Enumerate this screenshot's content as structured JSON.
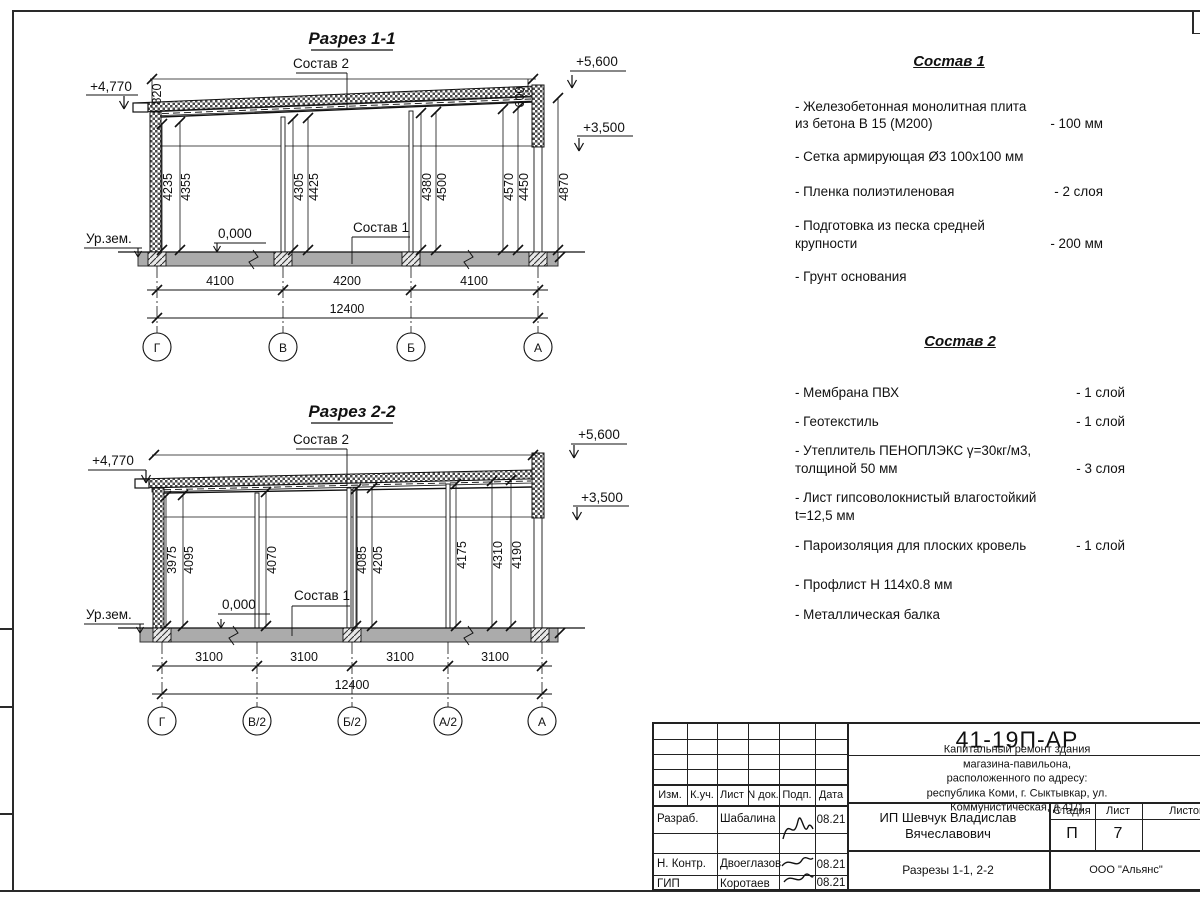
{
  "s1": {
    "title": "Разрез 1-1",
    "sostav2_label": "Состав 2",
    "sostav1_label": "Состав 1",
    "elev_eave": "+4,770",
    "elev_parapet": "+5,600",
    "elev_mid": "+3,500",
    "dim_820": "820",
    "dim_600": "600",
    "dim_4870": "4870",
    "zero": "0,000",
    "ground": "Ур.зем.",
    "heights": [
      "4235",
      "4355",
      "4305",
      "4425",
      "4380",
      "4500",
      "4570",
      "4450"
    ],
    "spans": [
      "4100",
      "4200",
      "4100"
    ],
    "total": "12400",
    "axes": [
      "Г",
      "В",
      "Б",
      "А"
    ]
  },
  "s2": {
    "title": "Разрез 2-2",
    "sostav2_label": "Состав 2",
    "sostav1_label": "Состав 1",
    "elev_eave": "+4,770",
    "elev_parapet": "+5,600",
    "elev_mid": "+3,500",
    "zero": "0,000",
    "ground": "Ур.зем.",
    "heights": [
      "3975",
      "4095",
      "4070",
      "4085",
      "4205",
      "4175",
      "4310",
      "4190"
    ],
    "spans": [
      "3100",
      "3100",
      "3100",
      "3100"
    ],
    "total": "12400",
    "axes": [
      "Г",
      "В/2",
      "Б/2",
      "А/2",
      "А"
    ]
  },
  "sostav1": {
    "title": "Состав 1",
    "items": [
      {
        "text": "- Железобетонная  монолитная плита\n  из бетона В 15 (М200)",
        "value": "- 100 мм"
      },
      {
        "text": "- Сетка армирующая Ø3 100х100 мм",
        "value": ""
      },
      {
        "text": "- Пленка полиэтиленовая",
        "value": "- 2 слоя"
      },
      {
        "text": "- Подготовка из песка средней\n  крупности",
        "value": "- 200 мм"
      },
      {
        "text": "- Грунт основания",
        "value": ""
      }
    ]
  },
  "sostav2": {
    "title": "Состав 2",
    "items": [
      {
        "text": "- Мембрана ПВХ",
        "value": "- 1 слой"
      },
      {
        "text": "- Геотекстиль",
        "value": "- 1 слой"
      },
      {
        "text": "- Утеплитель ПЕНОПЛЭКС γ=30кг/м3,\n  толщиной 50 мм",
        "value": "- 3 слоя"
      },
      {
        "text": "- Лист гипсоволокнистый влагостойкий\n t=12,5 мм",
        "value": ""
      },
      {
        "text": "- Пароизоляция для плоских кровель",
        "value": "- 1 слой"
      },
      {
        "text": "- Профлист Н 114х0.8 мм",
        "value": ""
      },
      {
        "text": "- Металлическая балка",
        "value": ""
      }
    ]
  },
  "sheet": {
    "code": "41-19П-АР",
    "project": "Капитальный ремонт здания магазина-павильона,\nрасположенного по адресу:\nреспублика Коми, г. Сыктывкар, ул. Коммунистическая, д.41/1",
    "client": "ИП Шевчук Владислав\nВячеславович",
    "sheet_title": "Разрезы 1-1, 2-2",
    "org": "ООО \"Альянс\"",
    "stage_label": "Стадия",
    "sheet_label": "Лист",
    "sheets_label": "Листов",
    "stage": "П",
    "sheet_no": "7",
    "cols": {
      "izm": "Изм.",
      "kuch": "К.уч.",
      "list": "Лист",
      "ndok": "N док.",
      "podp": "Подп.",
      "data": "Дата"
    },
    "rows": [
      {
        "role": "Разраб.",
        "name": "Шабалина",
        "date": "08.21"
      },
      {
        "role": "Н. Контр.",
        "name": "Двоеглазов",
        "date": "08.21"
      },
      {
        "role": "ГИП",
        "name": "Коротаев",
        "date": "08.21"
      }
    ]
  }
}
